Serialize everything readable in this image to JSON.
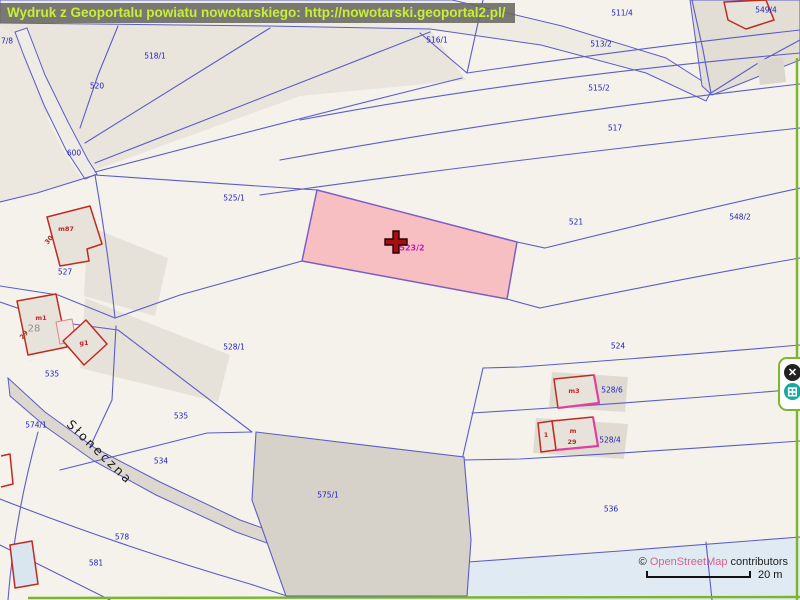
{
  "header": {
    "title": "Wydruk z Geoportalu powiatu nowotarskiego: http://nowotarski.geoportal2.pl/"
  },
  "map": {
    "selected_parcel_label": "523/2",
    "labels": [
      {
        "t": "7/8",
        "x": 7,
        "y": 41,
        "cls": "parcel"
      },
      {
        "t": "518/1",
        "x": 155,
        "y": 56,
        "cls": "parcel"
      },
      {
        "t": "520",
        "x": 97,
        "y": 86,
        "cls": "parcel"
      },
      {
        "t": "600",
        "x": 74,
        "y": 153,
        "cls": "parcel"
      },
      {
        "t": "516/1",
        "x": 437,
        "y": 40,
        "cls": "parcel"
      },
      {
        "t": "511/4",
        "x": 622,
        "y": 13,
        "cls": "parcel"
      },
      {
        "t": "513/2",
        "x": 601,
        "y": 44,
        "cls": "parcel"
      },
      {
        "t": "549/4",
        "x": 766,
        "y": 10,
        "cls": "parcel"
      },
      {
        "t": "515/2",
        "x": 599,
        "y": 88,
        "cls": "parcel"
      },
      {
        "t": "517",
        "x": 615,
        "y": 128,
        "cls": "parcel"
      },
      {
        "t": "548/2",
        "x": 740,
        "y": 217,
        "cls": "parcel"
      },
      {
        "t": "525/1",
        "x": 234,
        "y": 198,
        "cls": "parcel"
      },
      {
        "t": "521",
        "x": 576,
        "y": 222,
        "cls": "parcel"
      },
      {
        "t": "523/2",
        "x": 412,
        "y": 248,
        "cls": "selected"
      },
      {
        "t": "524",
        "x": 618,
        "y": 346,
        "cls": "parcel"
      },
      {
        "t": "528/1",
        "x": 234,
        "y": 347,
        "cls": "parcel"
      },
      {
        "t": "527",
        "x": 65,
        "y": 272,
        "cls": "parcel"
      },
      {
        "t": "535",
        "x": 52,
        "y": 374,
        "cls": "parcel"
      },
      {
        "t": "535",
        "x": 181,
        "y": 416,
        "cls": "parcel"
      },
      {
        "t": "534",
        "x": 161,
        "y": 461,
        "cls": "parcel"
      },
      {
        "t": "574/1",
        "x": 36,
        "y": 425,
        "cls": "parcel"
      },
      {
        "t": "575/1",
        "x": 328,
        "y": 495,
        "cls": "parcel"
      },
      {
        "t": "536",
        "x": 611,
        "y": 509,
        "cls": "parcel"
      },
      {
        "t": "578",
        "x": 122,
        "y": 537,
        "cls": "parcel"
      },
      {
        "t": "581",
        "x": 96,
        "y": 563,
        "cls": "parcel"
      },
      {
        "t": "528/6",
        "x": 612,
        "y": 390,
        "cls": "parcel"
      },
      {
        "t": "528/4",
        "x": 610,
        "y": 440,
        "cls": "parcel"
      },
      {
        "t": "m87",
        "x": 66,
        "y": 229,
        "cls": "building"
      },
      {
        "t": "m1",
        "x": 41,
        "y": 318,
        "cls": "building"
      },
      {
        "t": "g1",
        "x": 84,
        "y": 343,
        "cls": "building"
      },
      {
        "t": "m3",
        "x": 574,
        "y": 391,
        "cls": "building"
      },
      {
        "t": "m",
        "x": 573,
        "y": 431,
        "cls": "building"
      },
      {
        "t": "1",
        "x": 546,
        "y": 435,
        "cls": "building"
      },
      {
        "t": "28",
        "x": 34,
        "y": 329,
        "cls": "addr"
      },
      {
        "t": "30",
        "x": 49,
        "y": 240,
        "cls": "addr2",
        "rot": -50
      },
      {
        "t": "29",
        "x": 24,
        "y": 335,
        "cls": "addr2",
        "rot": -50
      },
      {
        "t": "29",
        "x": 572,
        "y": 442,
        "cls": "addr2"
      },
      {
        "t": "Słoneczna",
        "x": 100,
        "y": 452,
        "cls": "street",
        "rot": 44
      }
    ]
  },
  "attribution": {
    "copyright": "© ",
    "link": "OpenStreetMap",
    "suffix": " contributors"
  },
  "scale_bar": {
    "label": "20 m"
  },
  "side_panel": {
    "close_glyph": "✕",
    "grid_glyph": "⊞"
  },
  "colors": {
    "title_bg": "#696962",
    "title_text": "#c9ef35",
    "parcel_line_blue": "#5c5cc8",
    "parcel_label_blue": "#2222bd",
    "selected_fill": "#f8bfc3",
    "selected_label": "#c41fb5",
    "building_red": "#bf2b22",
    "building_accent_magenta": "#e040a0",
    "marker_red": "#a50f0f",
    "boundary_green": "#79b62c",
    "osm_link_pink": "#d6618f",
    "road_gray": "#dcd7cf",
    "area_gray": "#d7d2c9"
  }
}
